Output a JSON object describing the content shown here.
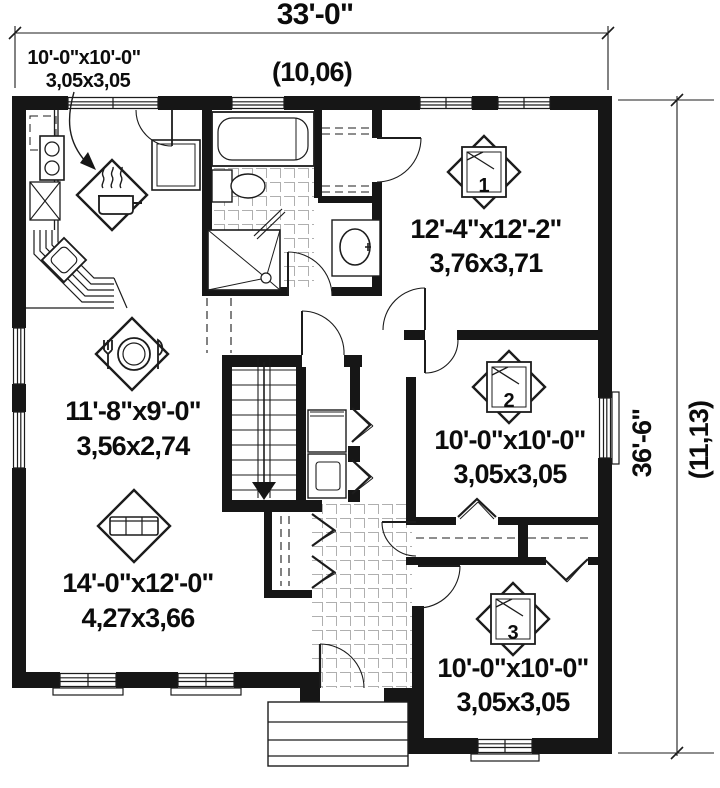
{
  "dimensions": {
    "top_width_imperial": "33'-0\"",
    "top_width_metric": "(10,06)",
    "side_height_imperial": "36'-6\"",
    "side_height_metric": "(11,13)"
  },
  "rooms": {
    "kitchen": {
      "imperial": "10'-0\"x10'-0\"",
      "metric": "3,05x3,05"
    },
    "dining": {
      "imperial": "11'-8\"x9'-0\"",
      "metric": "3,56x2,74"
    },
    "living": {
      "imperial": "14'-0\"x12'-0\"",
      "metric": "4,27x3,66"
    },
    "bedroom_1": {
      "imperial": "12'-4\"x12'-2\"",
      "metric": "3,76x3,71",
      "number": "1"
    },
    "bedroom_2": {
      "imperial": "10'-0\"x10'-0\"",
      "metric": "3,05x3,05",
      "number": "2"
    },
    "bedroom_3": {
      "imperial": "10'-0\"x10'-0\"",
      "metric": "3,05x3,05",
      "number": "3"
    }
  },
  "colors": {
    "walls": "#161616",
    "lines": "#1c1c1c",
    "background": "#ffffff"
  }
}
